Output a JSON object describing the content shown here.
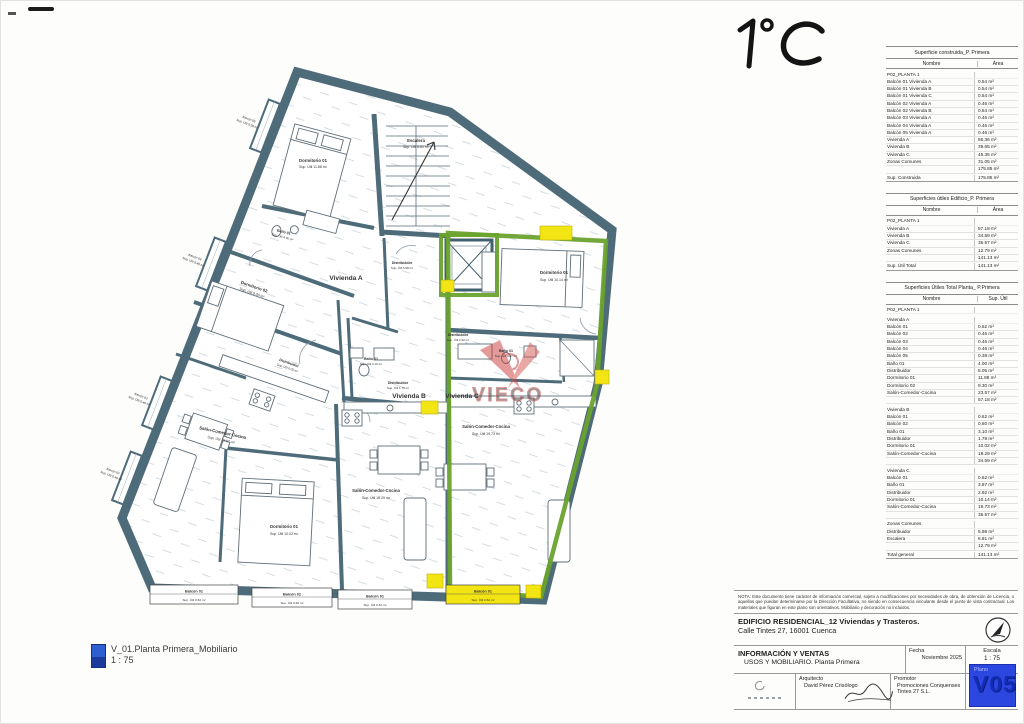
{
  "annotation": {
    "text": "1°C"
  },
  "legend": {
    "title": "V_01.Planta Primera_Mobiliario",
    "scale": "1 : 75"
  },
  "plan": {
    "vivienda_a": "Vivienda A",
    "vivienda_b": "Vivienda B",
    "vivienda_c": "Vivienda C",
    "watermark": "VIECO",
    "escalera_name": "Escalera",
    "escalera_area": "Sup. Útil 6.81 m²",
    "a_dorm1_name": "Dormitorio 01",
    "a_dorm1_area": "Sup. Útil 11.88 m²",
    "a_dorm2_name": "Dormitorio 02",
    "a_dorm2_area": "Sup. Útil 9.30 m²",
    "a_bano_name": "Baño 01",
    "a_bano_area": "Sup. Útil 4.00 m²",
    "a_distr_name": "Distribuidor",
    "a_distr_area": "Sup. Útil 6.05 m²",
    "a_salon_name": "Salón-Comedor-Cocina",
    "a_salon_area": "Sup. Útil 23.57 m²",
    "b_dorm1_name": "Dormitorio 01",
    "b_dorm1_area": "Sup. Útil 10.02 m²",
    "b_bano_name": "Baño 01",
    "b_bano_area": "Sup. Útil 3.10 m²",
    "b_distr_name": "Distribuidor",
    "b_distr_area": "Sup. Útil 1.78 m²",
    "b_salon_name": "Salón-Comedor-Cocina",
    "b_salon_area": "Sup. Útil 18.29 m²",
    "c_dorm1_name": "Dormitorio 01",
    "c_dorm1_area": "Sup. Útil 10.14 m²",
    "c_bano_name": "Baño 01",
    "c_bano_area": "Sup. Útil 3.87 m²",
    "c_distr_name": "Distribuidor",
    "c_distr_area": "Sup. Útil 2.92 m²",
    "c_salon_name": "Salón-Comedor-Cocina",
    "c_salon_area": "Sup. Útil 19.73 m²",
    "zc_distr_name": "Distribuidor",
    "zc_distr_area": "Sup. Útil 5.98 m²",
    "balc_a1_name": "Balcón 01",
    "balc_a1_area": "Sup. Útil 0.62 m²",
    "balc_b2_name": "Balcón 02",
    "balc_b2_area": "Sup. Útil 0.60 m²",
    "balc_b1_name": "Balcón 01",
    "balc_b1_area": "Sup. Útil 0.62 m²",
    "balc_c1_name": "Balcón 01",
    "balc_c1_area": "Sup. Útil 0.62 m²",
    "balc_05_name": "Balcón 05",
    "balc_05_area": "Sup. Útil 0.38 m²",
    "balc_04_name": "Balcón 04",
    "balc_04_area": "Sup. Útil 0.46 m²",
    "balc_03_name": "Balcón 03",
    "balc_03_area": "Sup. Útil 0.46 m²",
    "balc_02_name": "Balcón 02",
    "balc_02_area": "Sup. Útil 0.46 m²"
  },
  "tables": [
    {
      "title": "Superficie construida_P. Primera",
      "col_name": "Nombre",
      "col_value": "Área",
      "rows": [
        {
          "n": "P02_PLANTA 1",
          "v": "",
          "cls": "group"
        },
        {
          "n": "Balcón 01 Vivienda A",
          "v": "0.54 m²",
          "cls": "item"
        },
        {
          "n": "Balcón 01 Vivienda B",
          "v": "0.54 m²",
          "cls": "item"
        },
        {
          "n": "Balcón 01 Vivienda C",
          "v": "0.54 m²",
          "cls": "item"
        },
        {
          "n": "Balcón 02 Vivienda A",
          "v": "0.46 m²",
          "cls": "item"
        },
        {
          "n": "Balcón 02 Vivienda B",
          "v": "0.64 m²",
          "cls": "item"
        },
        {
          "n": "Balcón 03 Vivienda A",
          "v": "0.46 m²",
          "cls": "item"
        },
        {
          "n": "Balcón 04 Vivienda A",
          "v": "0.46 m²",
          "cls": "item"
        },
        {
          "n": "Balcón 05 Vivienda A",
          "v": "0.46 m²",
          "cls": "item"
        },
        {
          "n": "Vivienda A",
          "v": "56.36 m²",
          "cls": "item"
        },
        {
          "n": "Vivienda B",
          "v": "39.65 m²",
          "cls": "item"
        },
        {
          "n": "Vivienda C",
          "v": "45.35 m²",
          "cls": "item"
        },
        {
          "n": "Zonas Comunes",
          "v": "31.05 m²",
          "cls": "item"
        },
        {
          "n": "",
          "v": "175.85 m²",
          "cls": "sub"
        },
        {
          "n": "Sup. Construida",
          "v": "175.85 m²",
          "cls": "total"
        }
      ]
    },
    {
      "title": "Superficies útiles Edificio_P. Primera",
      "col_name": "Nombre",
      "col_value": "Área",
      "rows": [
        {
          "n": "P02_PLANTA 1",
          "v": "",
          "cls": "group"
        },
        {
          "n": "Vivienda A",
          "v": "57.18 m²",
          "cls": "item"
        },
        {
          "n": "Vivienda B",
          "v": "34.59 m²",
          "cls": "item"
        },
        {
          "n": "Vivienda C",
          "v": "36.57 m²",
          "cls": "item"
        },
        {
          "n": "Zonas Comunes",
          "v": "12.79 m²",
          "cls": "item"
        },
        {
          "n": "",
          "v": "141.13 m²",
          "cls": "sub"
        },
        {
          "n": "Sup. Útil Total",
          "v": "141.13 m²",
          "cls": "total"
        }
      ]
    },
    {
      "title": "Superficies Útiles Total Planta_ P.Primera",
      "col_name": "Nombre",
      "col_value": "Sup. Útil",
      "rows": [
        {
          "n": "P02_PLANTA 1",
          "v": "",
          "cls": "group"
        },
        {
          "n": "Vivienda A",
          "v": "",
          "cls": "group"
        },
        {
          "n": "Balcón 01",
          "v": "0.62 m²",
          "cls": "item"
        },
        {
          "n": "Balcón 02",
          "v": "0.46 m²",
          "cls": "item"
        },
        {
          "n": "Balcón 03",
          "v": "0.46 m²",
          "cls": "item"
        },
        {
          "n": "Balcón 04",
          "v": "0.46 m²",
          "cls": "item"
        },
        {
          "n": "Balcón 05",
          "v": "0.38 m²",
          "cls": "item"
        },
        {
          "n": "Baño 01",
          "v": "4.00 m²",
          "cls": "item"
        },
        {
          "n": "Distribuidor",
          "v": "6.05 m²",
          "cls": "item"
        },
        {
          "n": "Dormitorio 01",
          "v": "11.88 m²",
          "cls": "item"
        },
        {
          "n": "Dormitorio 02",
          "v": "9.30 m²",
          "cls": "item"
        },
        {
          "n": "Salón-Comedor-Cocina",
          "v": "23.57 m²",
          "cls": "item"
        },
        {
          "n": "",
          "v": "57.18 m²",
          "cls": "sub"
        },
        {
          "n": "Vivienda B",
          "v": "",
          "cls": "group"
        },
        {
          "n": "Balcón 01",
          "v": "0.62 m²",
          "cls": "item"
        },
        {
          "n": "Balcón 02",
          "v": "0.60 m²",
          "cls": "item"
        },
        {
          "n": "Baño 01",
          "v": "3.10 m²",
          "cls": "item"
        },
        {
          "n": "Distribuidor",
          "v": "1.78 m²",
          "cls": "item"
        },
        {
          "n": "Dormitorio 01",
          "v": "10.02 m²",
          "cls": "item"
        },
        {
          "n": "Salón-Comedor-Cocina",
          "v": "18.29 m²",
          "cls": "item"
        },
        {
          "n": "",
          "v": "34.59 m²",
          "cls": "sub"
        },
        {
          "n": "Vivienda C",
          "v": "",
          "cls": "group"
        },
        {
          "n": "Balcón 01",
          "v": "0.62 m²",
          "cls": "item"
        },
        {
          "n": "Baño 01",
          "v": "3.87 m²",
          "cls": "item"
        },
        {
          "n": "Distribuidor",
          "v": "2.92 m²",
          "cls": "item"
        },
        {
          "n": "Dormitorio 01",
          "v": "10.14 m²",
          "cls": "item"
        },
        {
          "n": "Salón-Comedor-Cocina",
          "v": "19.73 m²",
          "cls": "item"
        },
        {
          "n": "",
          "v": "36.57 m²",
          "cls": "sub"
        },
        {
          "n": "Zonas Comunes",
          "v": "",
          "cls": "group"
        },
        {
          "n": "Distribuidor",
          "v": "5.98 m²",
          "cls": "item"
        },
        {
          "n": "Escalera",
          "v": "6.81 m²",
          "cls": "item"
        },
        {
          "n": "",
          "v": "12.79 m²",
          "cls": "sub"
        },
        {
          "n": "Total general",
          "v": "141.13 m²",
          "cls": "total"
        }
      ]
    }
  ],
  "nota": "NOTA: Este documento tiene carácter de información comercial, sujeto a modificaciones por necesidades de obra, de obtención de Licencia, o aquellas que puedan determinarse por la Dirección Facultativa, no siendo en consecuencia vinculante desde el punto de vista contractual. Los materiales que figuran en este plano son orientativos. Mobiliario y decoración no incluidos.",
  "titleblock": {
    "project_line1": "EDIFICIO RESIDENCIAL_12 Viviendas y Trasteros.",
    "project_line2": "Calle Tintes 27, 16001 Cuenca",
    "doc_title1": "INFORMACIÓN Y VENTAS",
    "doc_title2": "USOS Y MOBILIARIO. Planta Primera",
    "fecha_label": "Fecha",
    "fecha": "Noviembre 2025",
    "escala_label": "Escala",
    "escala": "1 : 75",
    "arquitecto_label": "Arquitecto",
    "arquitecto": "David Pérez Crisólogo",
    "promotor_label": "Promotor",
    "promotor": "Promociones Conquenses Tintes 27 S.L.",
    "plano_label": "Plano",
    "plano_num": "V05"
  },
  "colors": {
    "wall": "#4e6b7a",
    "vivienda_c_outline": "#6aa32e",
    "highlight": "#f3e514",
    "watermark_red": "#c93a36",
    "plano_blue": "#2b47df"
  }
}
